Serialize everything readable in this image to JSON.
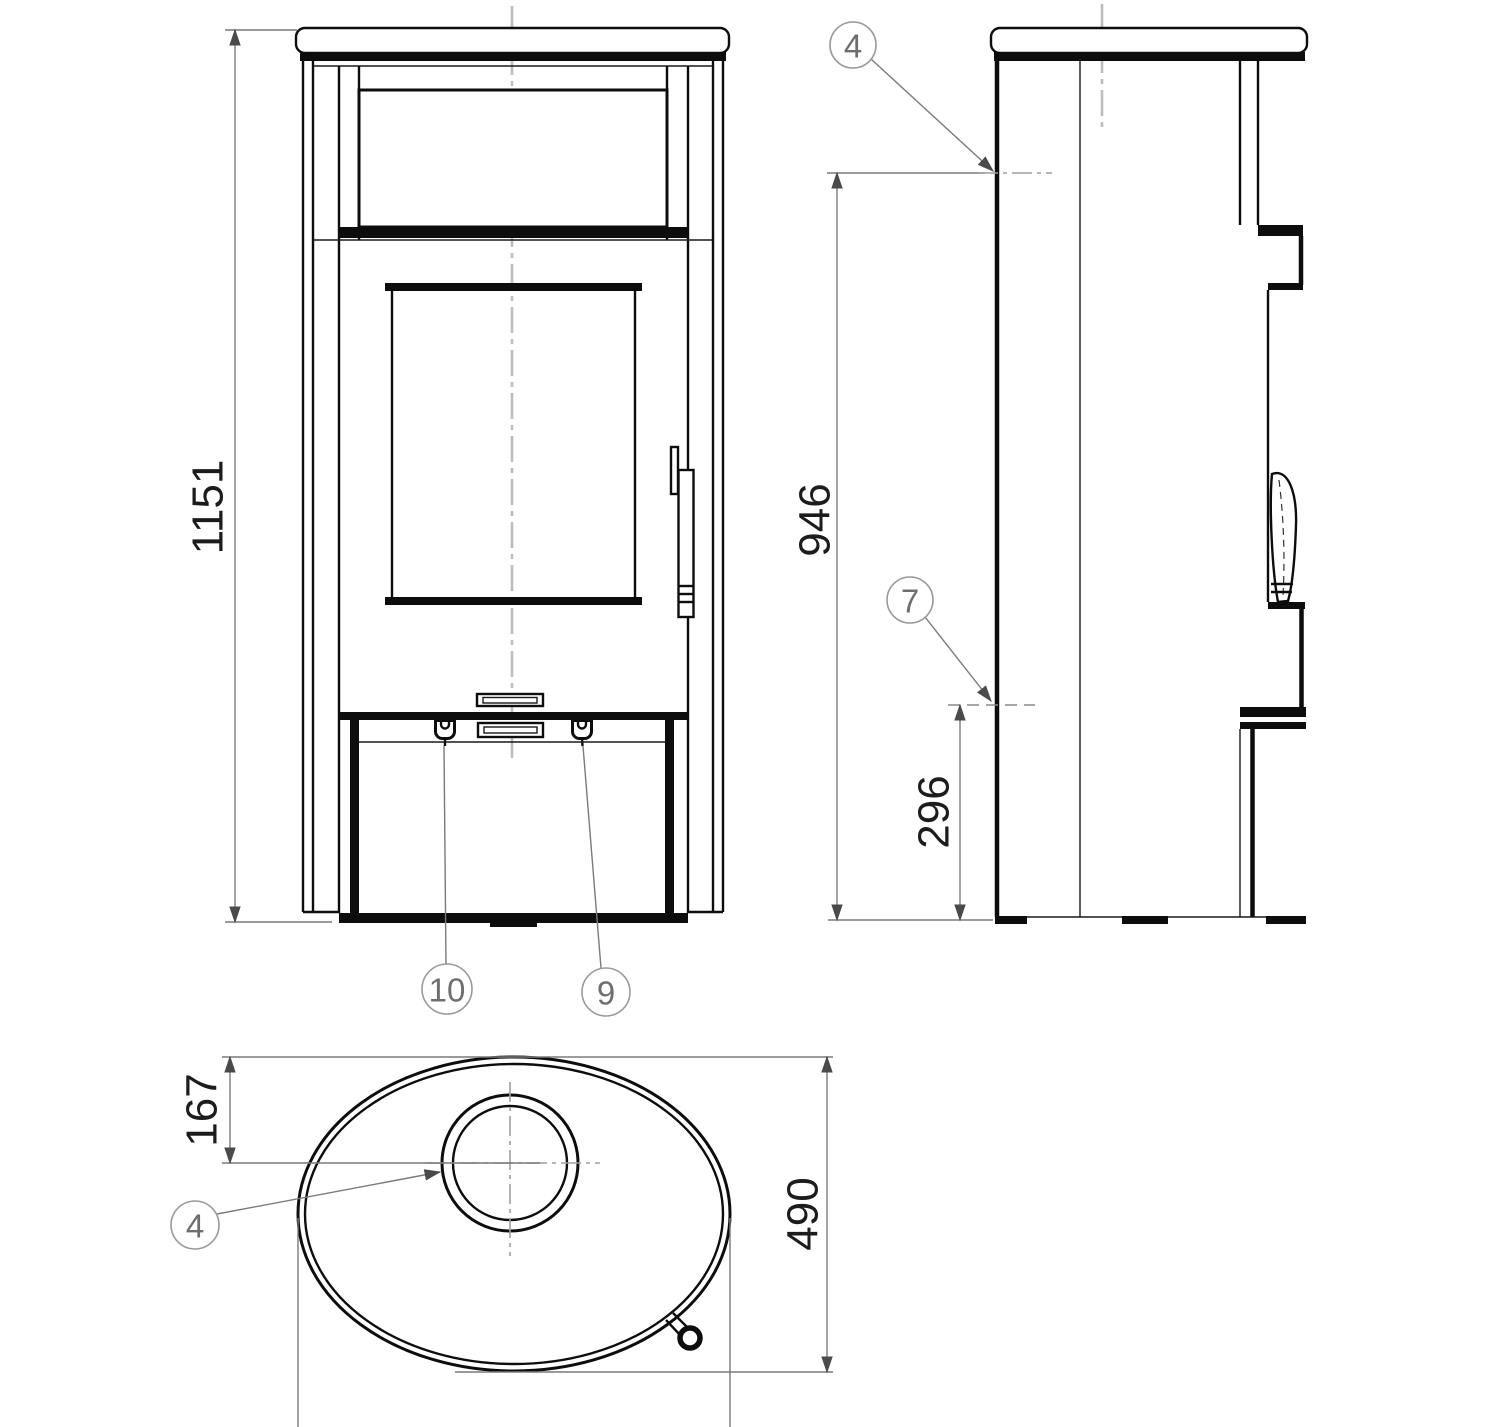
{
  "dimensions": {
    "overall_height": "1151",
    "rear_flue_height": "946",
    "rear_lower_height": "296",
    "flue_back_offset": "167",
    "base_depth": "490"
  },
  "callouts": {
    "side_top_plate": "4",
    "side_rear_outlet": "7",
    "front_knob_left": "10",
    "front_knob_right": "9",
    "top_flue_collar": "4"
  }
}
